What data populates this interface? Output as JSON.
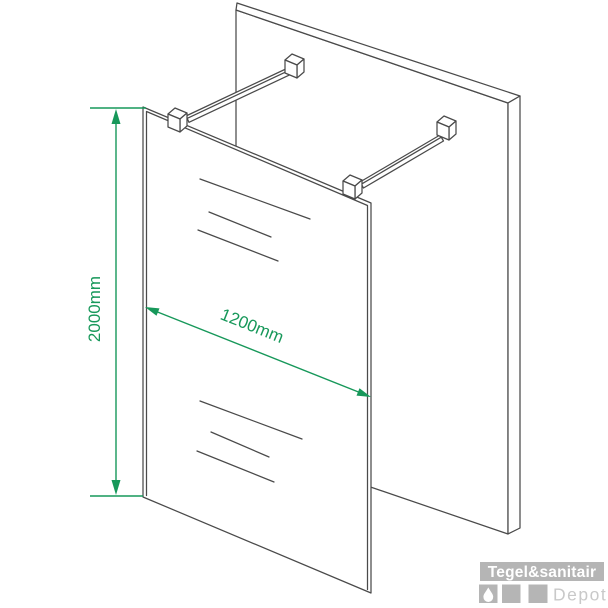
{
  "diagram": {
    "type": "isometric technical drawing of walk-in shower glass panel with wall support bars",
    "height_label": "2000mm",
    "width_label": "1200mm"
  },
  "logo": {
    "brand": "Tegel&sanitair",
    "sub": "Depot"
  },
  "colors": {
    "dimension_green": "#17985a",
    "line_gray": "#4a4a4a",
    "logo_gray": "#b5b5b5",
    "logo_light_gray": "#c9c9c9",
    "white": "#ffffff"
  }
}
